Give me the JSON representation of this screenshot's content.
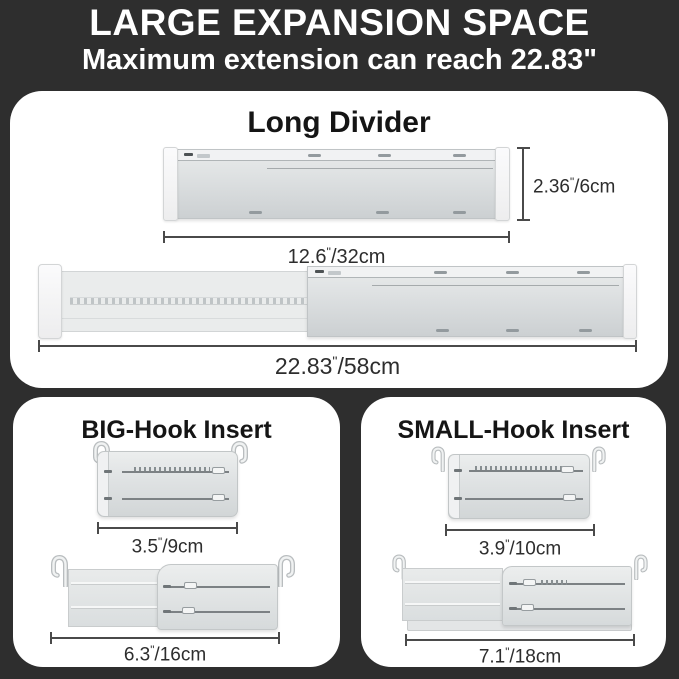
{
  "colors": {
    "background": "#2e2e2e",
    "panel": "#ffffff",
    "heading_text": "#ffffff",
    "title_text": "#151515",
    "dimension_text": "#2d2d2d",
    "dimension_line": "#4a4a4a",
    "divider_gray": "#ced2d3",
    "cap_white": "#f7f7f8"
  },
  "header": {
    "title": "LARGE EXPANSION SPACE",
    "subtitle": "Maximum extension can reach 22.83\""
  },
  "long_divider": {
    "title": "Long Divider",
    "height": {
      "num": "2.36",
      "mark": "\"",
      "rest": "/6cm"
    },
    "collapsed_length": {
      "num": "12.6",
      "mark": "\"",
      "rest": "/32cm"
    },
    "extended_length": {
      "num": "22.83",
      "mark": "\"",
      "rest": "/58cm"
    }
  },
  "big_hook": {
    "title": "BIG-Hook Insert",
    "collapsed_length": {
      "num": "3.5",
      "mark": "\"",
      "rest": "/9cm"
    },
    "extended_length": {
      "num": "6.3",
      "mark": "\"",
      "rest": "/16cm"
    }
  },
  "small_hook": {
    "title": "SMALL-Hook Insert",
    "collapsed_length": {
      "num": "3.9",
      "mark": "\"",
      "rest": "/10cm"
    },
    "extended_length": {
      "num": "7.1",
      "mark": "\"",
      "rest": "/18cm"
    }
  }
}
